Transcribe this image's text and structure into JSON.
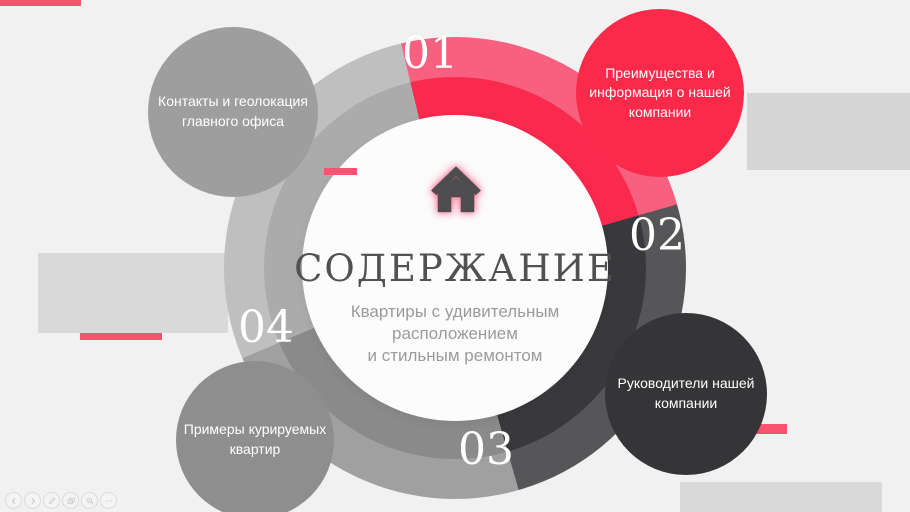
{
  "slide": {
    "title": "СОДЕРЖАНИЕ",
    "subtitle_lines": [
      "Квартиры с удивительным",
      "расположением",
      "и стильным ремонтом"
    ],
    "center_icon": "home"
  },
  "sections": [
    {
      "number": "01",
      "label": "Преимущества и информация о нашей компании",
      "color": "#fb2a4b",
      "bubble_position": "top-right"
    },
    {
      "number": "02",
      "label": "Руководители нашей компании",
      "color": "#353537",
      "bubble_position": "bottom-right"
    },
    {
      "number": "03",
      "label": "Примеры курируемых квартир",
      "color": "#8e8e8e",
      "bubble_position": "bottom-left"
    },
    {
      "number": "04",
      "label": "Контакты и геолокация главного офиса",
      "color": "#9e9e9e",
      "bubble_position": "top-left"
    }
  ],
  "colors": {
    "background": "#f1f1f2",
    "accent_pink": "#f8546f",
    "ring_red_outer": "#f7607e",
    "ring_red_inner": "#f92a4d",
    "ring_dark_outer": "#565658",
    "ring_dark_inner": "#39393b",
    "ring_gray_outer": "#a0a0a0",
    "ring_gray_inner": "#8a8a8a",
    "ring_light_outer": "#bfbfbf",
    "ring_light_inner": "#ababab",
    "title_text": "#515151",
    "subtitle_text": "#9b9b9b",
    "decor_rect": "#d9d9d9"
  },
  "controls": {
    "items": [
      {
        "name": "previous-slide"
      },
      {
        "name": "next-slide"
      },
      {
        "name": "pen"
      },
      {
        "name": "all-slides"
      },
      {
        "name": "zoom"
      },
      {
        "name": "more-options"
      }
    ]
  }
}
